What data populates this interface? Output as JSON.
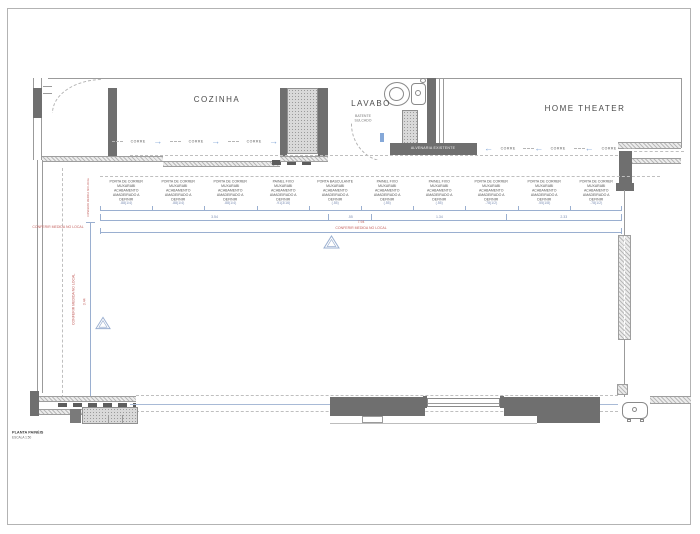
{
  "title_block": {
    "title": "PLANTA PAINÉIS",
    "scale": "ESCALA 1:50"
  },
  "rooms": {
    "kitchen": "COZINHA",
    "bathroom": "LAVABO",
    "home_theater": "HOME THEATER"
  },
  "annotations": {
    "wall": "ALVENARIA EXISTENTE",
    "jamb": "BATENTE\nSULCADO",
    "slide_label": "CORRE",
    "site_note": "CONFERIR MEDIDA NO LOCAL"
  },
  "panels": {
    "items": [
      {
        "label": "PORTA DE CORRER\nMUXARABI\nACABAMENTO\nAMADEIRADO A\nDEFINIR",
        "dim": ".88(1/4)"
      },
      {
        "label": "PORTA DE CORRER\nMUXARABI\nACABAMENTO\nAMADEIRADO A\nDEFINIR",
        "dim": ".88(1/4)"
      },
      {
        "label": "PORTA DE CORRER\nMUXARABI\nACABAMENTO\nAMADEIRADO A\nDEFINIR",
        "dim": ".88(1/4)"
      },
      {
        "label": "PAINEL FIXO\nMUXARABI\nACABAMENTO\nAMADEIRADO A\nDEFINIR",
        "dim": ".91(3/16)"
      },
      {
        "label": "PORTA BASCULANTE\nMUXARABI\nACABAMENTO\nAMADEIRADO A\nDEFINIR",
        "dim": "(.55)"
      },
      {
        "label": "PAINEL FIXO\nMUXARABI\nACABAMENTO\nAMADEIRADO A\nDEFINIR",
        "dim": "(.55)"
      },
      {
        "label": "PAINEL FIXO\nMUXARABI\nACABAMENTO\nAMADEIRADO A\nDEFINIR",
        "dim": "(.55)"
      },
      {
        "label": "PORTA DE CORRER\nMUXARABI\nACABAMENTO\nAMADEIRADO A\nDEFINIR",
        "dim": ".78(1/2)"
      },
      {
        "label": "PORTA DE CORRER\nMUXARABI\nACABAMENTO\nAMADEIRADO A\nDEFINIR",
        "dim": ".55(1/8)"
      },
      {
        "label": "PORTA DE CORRER\nMUXARABI\nACABAMENTO\nAMADEIRADO A\nDEFINIR",
        "dim": ".78(1/2)"
      }
    ],
    "subtotals": [
      {
        "value": "3.54"
      },
      {
        "value": ".55"
      },
      {
        "value": "1.34"
      },
      {
        "value": "2.33"
      }
    ],
    "total": {
      "value": "7.94",
      "note": "CONFERIR MEDIDA NO LOCAL"
    }
  },
  "left_dim": {
    "value": "3.44"
  },
  "colors": {
    "wall_dark": "#6f6f6f",
    "dimension_blue": "#9aafd0",
    "arrow_blue": "#85a8d8",
    "note_red": "#c4625f"
  }
}
